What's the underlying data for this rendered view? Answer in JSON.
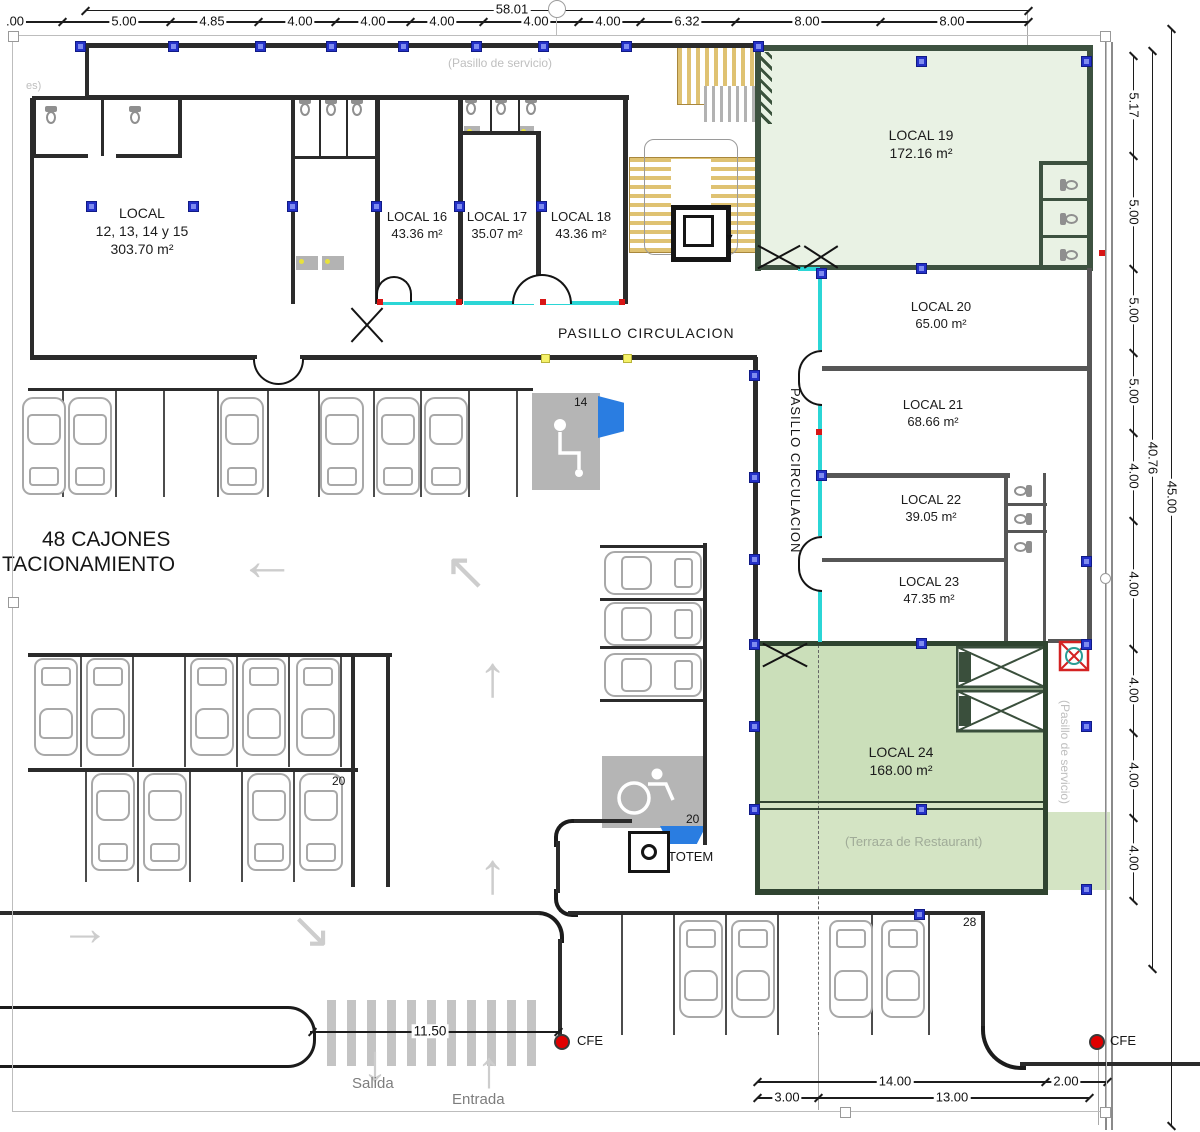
{
  "plan": {
    "rooms": [
      {
        "name": "LOCAL",
        "sub": "12, 13, 14 y 15",
        "area": "303.70 m²"
      },
      {
        "name": "LOCAL 16",
        "area": "43.36 m²"
      },
      {
        "name": "LOCAL 17",
        "area": "35.07 m²"
      },
      {
        "name": "LOCAL 18",
        "area": "43.36 m²"
      },
      {
        "name": "LOCAL 19",
        "area": "172.16 m²"
      },
      {
        "name": "LOCAL 20",
        "area": "65.00 m²"
      },
      {
        "name": "LOCAL 21",
        "area": "68.66 m²"
      },
      {
        "name": "LOCAL 22",
        "area": "39.05 m²"
      },
      {
        "name": "LOCAL 23",
        "area": "47.35 m²"
      },
      {
        "name": "LOCAL 24",
        "area": "168.00 m²"
      }
    ],
    "corridors": {
      "horizontal": "PASILLO CIRCULACION",
      "vertical": "PASILLO CIRCULACION",
      "service_top": "(Pasill­o de servicio)",
      "service_left": "es)",
      "service_right": "(Pasillo de servicio)",
      "terrace": "(Terraza de Restaurant)"
    },
    "parking": {
      "count_line1": "48 CAJONES",
      "count_line2": "TACIONAMIENTO",
      "stalls": [
        "14",
        "20",
        "20",
        "28"
      ]
    },
    "site": {
      "totem": "TOTEM",
      "cfe_left": "CFE",
      "cfe_right": "CFE",
      "exit": "Salida",
      "entrance": "Entrada"
    },
    "dimensions": {
      "top_total": "58.01",
      "top": [
        ".00",
        "5.00",
        "4.85",
        "4.00",
        "4.00",
        "4.00",
        "4.00",
        "4.00",
        "6.32",
        "8.00",
        "8.00"
      ],
      "right": [
        "5.17",
        "5.00",
        "5.00",
        "5.00",
        "4.00",
        "4.00",
        "4.00",
        "4.00",
        "4.00"
      ],
      "right_total_inner": "40.76",
      "right_total_outer": "45.00",
      "bottom_entry": "11.50",
      "bottom_row1": [
        "14.00",
        "2.00"
      ],
      "bottom_row2": [
        "3.00",
        "13.00"
      ]
    },
    "colors": {
      "room_green_light": "#e9f2e4",
      "room_green": "#cbdfba",
      "terrace_green": "#d4e4c4",
      "storefront_cyan": "#2bd6d6",
      "stair_gold": "#dfc272",
      "marker_blue": "#2431c8",
      "cfe_red": "#dd1111"
    }
  }
}
